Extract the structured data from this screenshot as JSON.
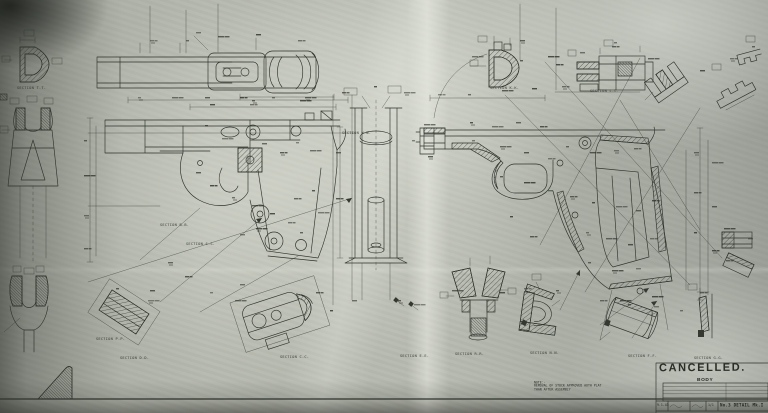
{
  "drawing": {
    "stamp_text": "CANCELLED.",
    "part_name": "BODY",
    "note": {
      "label": "NOTE:-",
      "lines": [
        "REMOVAL OF STOCK APPROVED AUTH PLAT",
        "THAN AFTER ASSEMBLY"
      ]
    },
    "title_block": {
      "info_rows": [
        "SCALE",
        "DATE",
        "DRAWN",
        "MATERIAL",
        "CHECKED"
      ],
      "bottom_row": {
        "date": "9.1.43",
        "scale": "1/1",
        "title": "No.3 DETAIL Mk.I"
      }
    },
    "section_labels": [
      {
        "text": "SECTION T-T.",
        "x": 17,
        "y": 86
      },
      {
        "text": "SECTION B-B.",
        "x": 160,
        "y": 223
      },
      {
        "text": "SECTION S-S.",
        "x": 186,
        "y": 242
      },
      {
        "text": "SECTION P-P.",
        "x": 96,
        "y": 337
      },
      {
        "text": "SECTION D-D.",
        "x": 120,
        "y": 356
      },
      {
        "text": "SECTION C-C.",
        "x": 280,
        "y": 355
      },
      {
        "text": "SECTION E-E.",
        "x": 400,
        "y": 354
      },
      {
        "text": "SECTION R-R.",
        "x": 455,
        "y": 352
      },
      {
        "text": "SECTION N-N.",
        "x": 530,
        "y": 351
      },
      {
        "text": "SECTION F-F.",
        "x": 628,
        "y": 354
      },
      {
        "text": "SECTION G-G.",
        "x": 694,
        "y": 356
      },
      {
        "text": "SECTION K-K.",
        "x": 490,
        "y": 86
      },
      {
        "text": "SECTION L-L.",
        "x": 590,
        "y": 89
      },
      {
        "text": "SECTION W-W.",
        "x": 342,
        "y": 131
      }
    ],
    "colors": {
      "ink": "#2e332c",
      "paper": "#b7bab0"
    }
  }
}
